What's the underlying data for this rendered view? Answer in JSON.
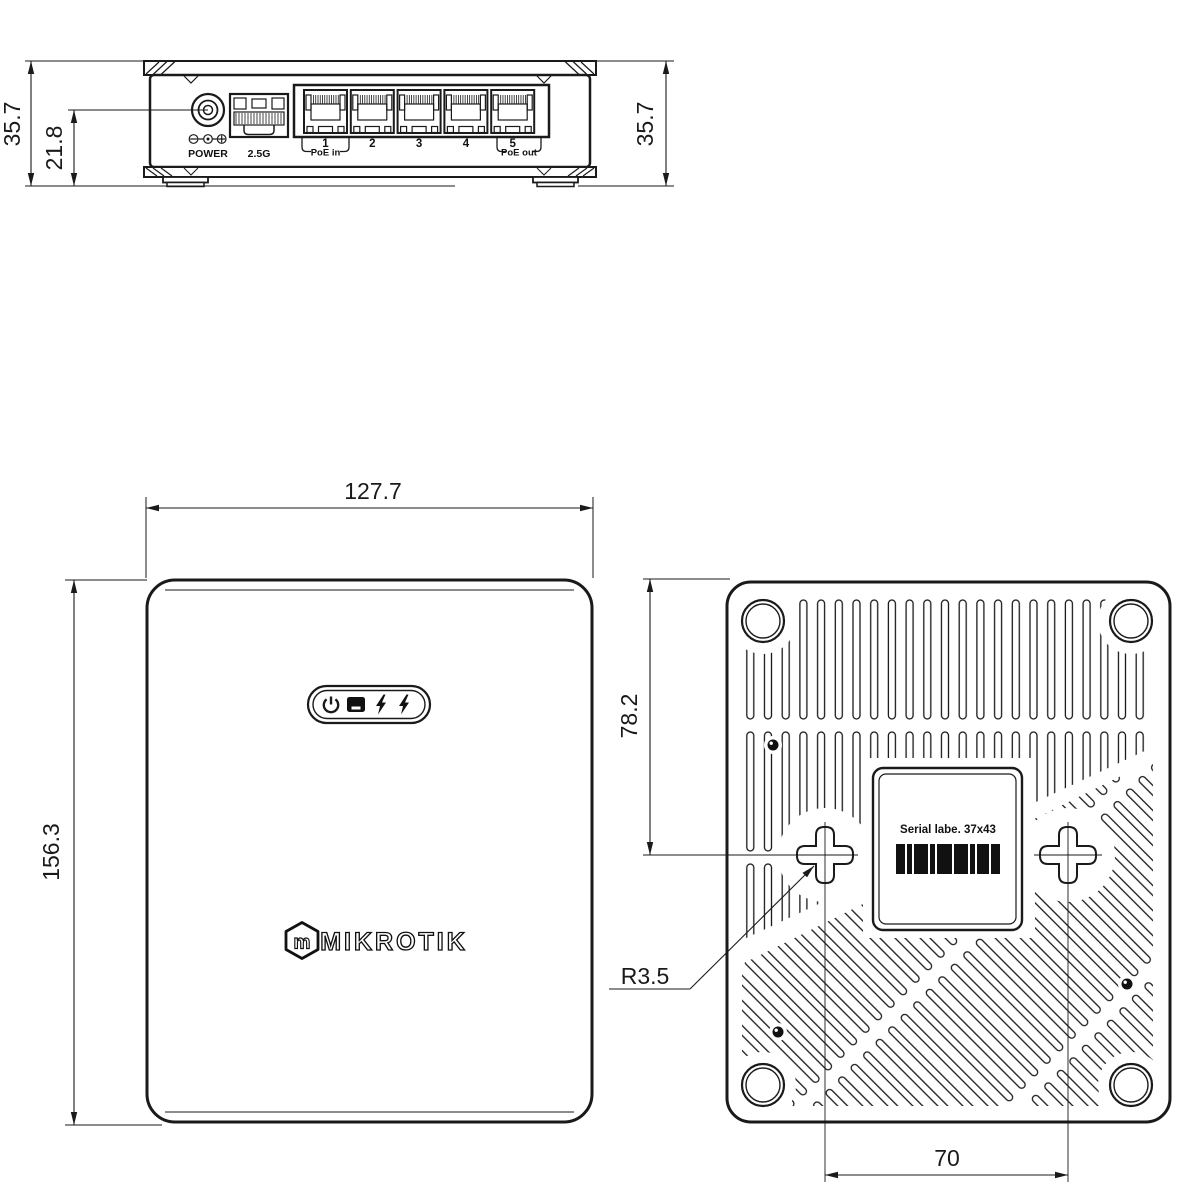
{
  "rear_panel": {
    "dim_total_height_left": "35.7",
    "dim_connector_height": "21.8",
    "dim_total_height_right": "35.7",
    "power_jack_label": "POWER",
    "sfp_port_label": "2.5G",
    "ethernet_ports": [
      "1",
      "2",
      "3",
      "4",
      "5"
    ],
    "poe_in_label": "PoE in",
    "poe_out_label": "PoE out"
  },
  "top_cover": {
    "dim_width": "127.7",
    "dim_depth": "156.3",
    "brand_text": "MIKROTIK",
    "logo_monogram": "m",
    "led_icons": [
      "power-led",
      "sfp-led",
      "poe-led",
      "poe-led"
    ]
  },
  "bottom_panel": {
    "dim_mount_hole_offset": "78.2",
    "mount_slot_radius_label": "R3.5",
    "dim_mount_hole_spacing": "70",
    "serial_label_text": "Serial labe. 37x43"
  },
  "colors": {
    "line": "#1a1a1a",
    "background": "#ffffff"
  }
}
